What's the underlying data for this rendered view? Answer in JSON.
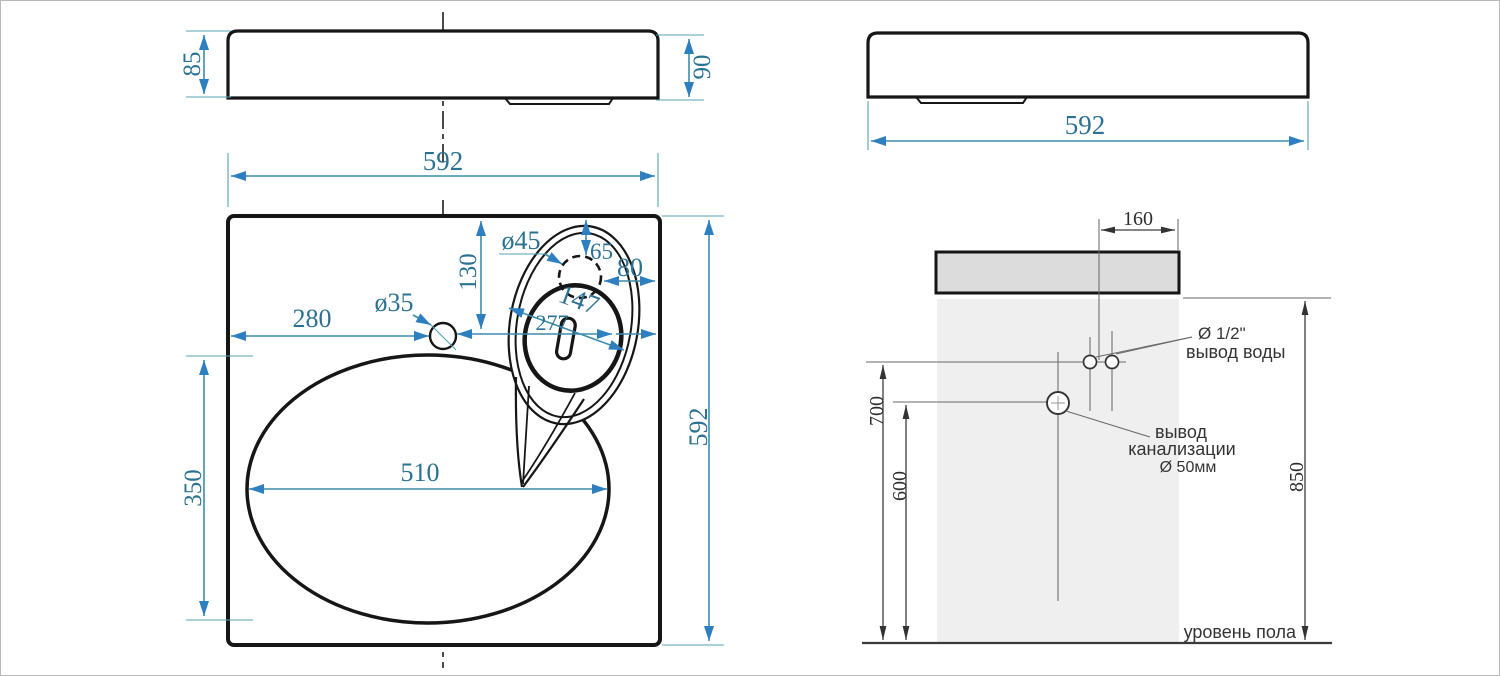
{
  "document_title": "Чертёж раковины с размерами и схемой монтажа",
  "front_view": {
    "height_left": "85",
    "height_right": "90",
    "width": "592"
  },
  "plan_view": {
    "width": "592",
    "depth": "592",
    "basin_width": "510",
    "basin_depth": "350",
    "faucet_hole": "ø35",
    "faucet_to_left": "280",
    "faucet_to_back": "130",
    "overflow_hole": "ø45",
    "overflow_to_back": "65",
    "overflow_to_right": "80",
    "overflow_diagonal": "147",
    "overflow_to_faucet": "277"
  },
  "side_view": {
    "width": "592"
  },
  "installation": {
    "tap_offset": "160",
    "water_outlet_height": "700",
    "drain_outlet_height": "600",
    "rim_height": "850",
    "water_outlet_size": "Ø 1/2\"",
    "water_outlet_label": "вывод воды",
    "drain_label_line1": "вывод",
    "drain_label_line2": "канализации",
    "drain_size": "Ø 50мм",
    "floor_label": "уровень пола"
  },
  "colors": {
    "object_line": "#161616",
    "dim_line_teal": "#3e8cab",
    "dim_text_teal": "#2b7292",
    "arrow_blue": "#2e7fc0",
    "dark_line": "#3d3d3d",
    "dark_text": "#333333",
    "sink_fill": "#dcdcdc",
    "wall_zone_fill": "#efefef",
    "background": "#ffffff"
  }
}
